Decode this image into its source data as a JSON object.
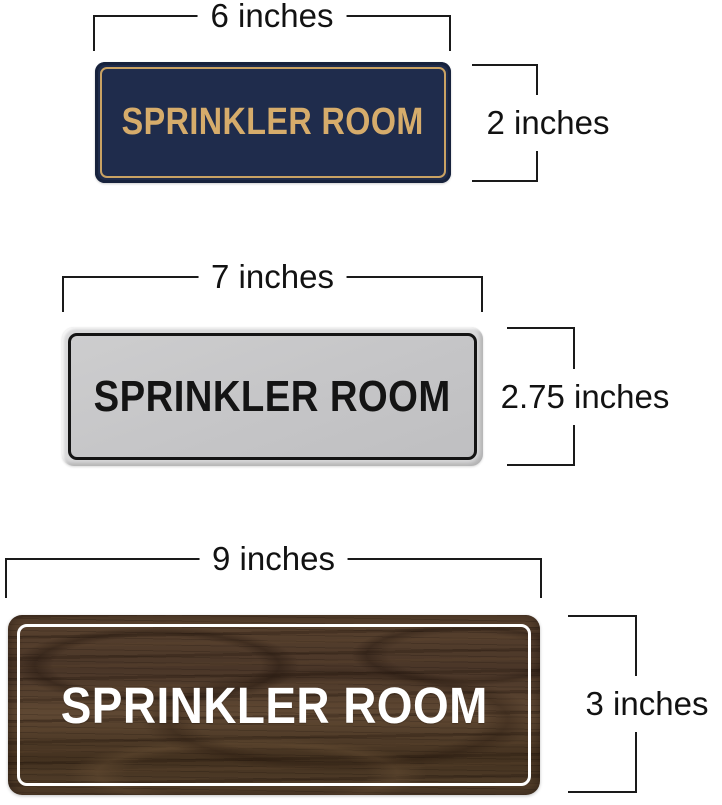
{
  "page": {
    "background": "#ffffff",
    "dimension_line_color": "#1a1a1a",
    "dimension_text_color": "#121212"
  },
  "figures": [
    {
      "id": "navy-gold-sign",
      "width_label": "6 inches",
      "height_label": "2 inches",
      "sign_text": "SPRINKLER ROOM",
      "colors": {
        "background": "#1f2c4c",
        "text": "#d6ac6b",
        "border": "#c9a263"
      }
    },
    {
      "id": "silver-black-sign",
      "width_label": "7 inches",
      "height_label": "2.75 inches",
      "sign_text": "SPRINKLER ROOM",
      "colors": {
        "edge": "#d9d9da",
        "background": "#c6c6c8",
        "text": "#141414",
        "border": "#141414"
      }
    },
    {
      "id": "walnut-white-sign",
      "width_label": "9 inches",
      "height_label": "3 inches",
      "sign_text": "SPRINKLER ROOM",
      "colors": {
        "background": "#4f3a2b",
        "wood_dark": "#35271b",
        "wood_light": "#6a5138",
        "text": "#ffffff",
        "border": "#ffffff"
      }
    }
  ]
}
